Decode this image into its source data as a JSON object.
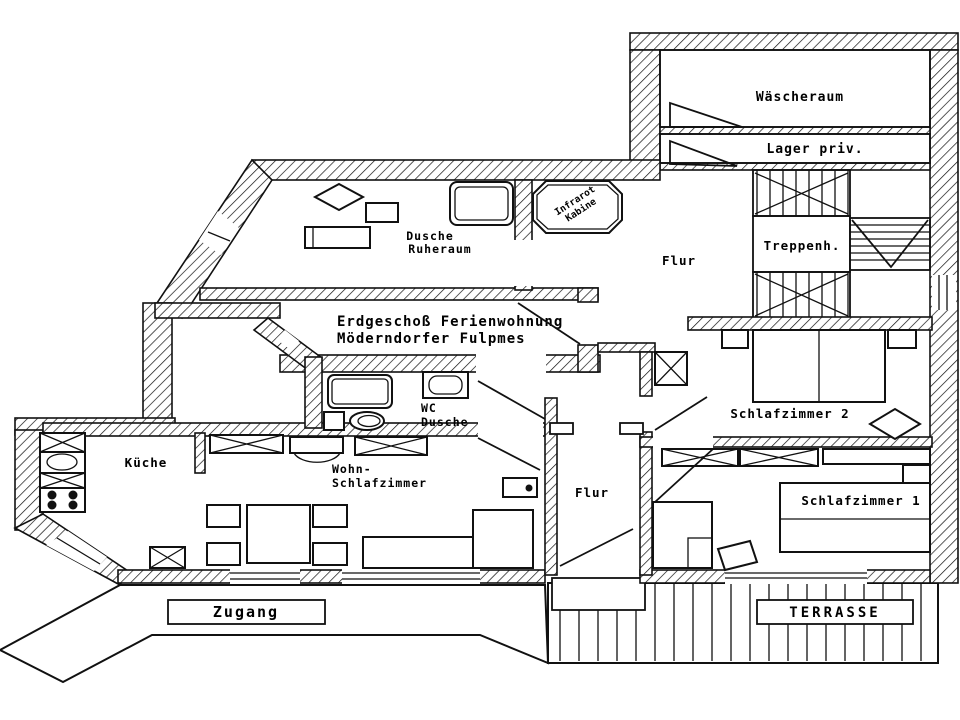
{
  "meta": {
    "ink_color": "#000000",
    "paper_color": "#ffffff",
    "drawing_type": "floor plan"
  },
  "title": {
    "line1": "Erdgeschoß Ferienwohnung",
    "line2": "Möderndorfer Fulpmes"
  },
  "rooms": {
    "waescheraum": {
      "label": "Wäscheraum"
    },
    "lager": {
      "label": "Lager priv."
    },
    "treppenhaus": {
      "label": "Treppenh."
    },
    "flur_upper": {
      "label": "Flur"
    },
    "flur_lower": {
      "label": "Flur"
    },
    "dusche_ruheraum": {
      "line1": "Dusche",
      "line2": "Ruheraum"
    },
    "infrarot_kabine": {
      "line1": "Infrarot",
      "line2": "Kabine"
    },
    "wc_dusche": {
      "line1": "WC",
      "line2": "Dusche"
    },
    "kueche": {
      "label": "Küche"
    },
    "wohn_schlafzimmer": {
      "line1": "Wohn-",
      "line2": "Schlafzimmer"
    },
    "schlafzimmer1": {
      "label": "Schlafzimmer 1"
    },
    "schlafzimmer2": {
      "label": "Schlafzimmer 2"
    }
  },
  "outdoor": {
    "zugang": "Zugang",
    "terrasse": "TERRASSE"
  }
}
